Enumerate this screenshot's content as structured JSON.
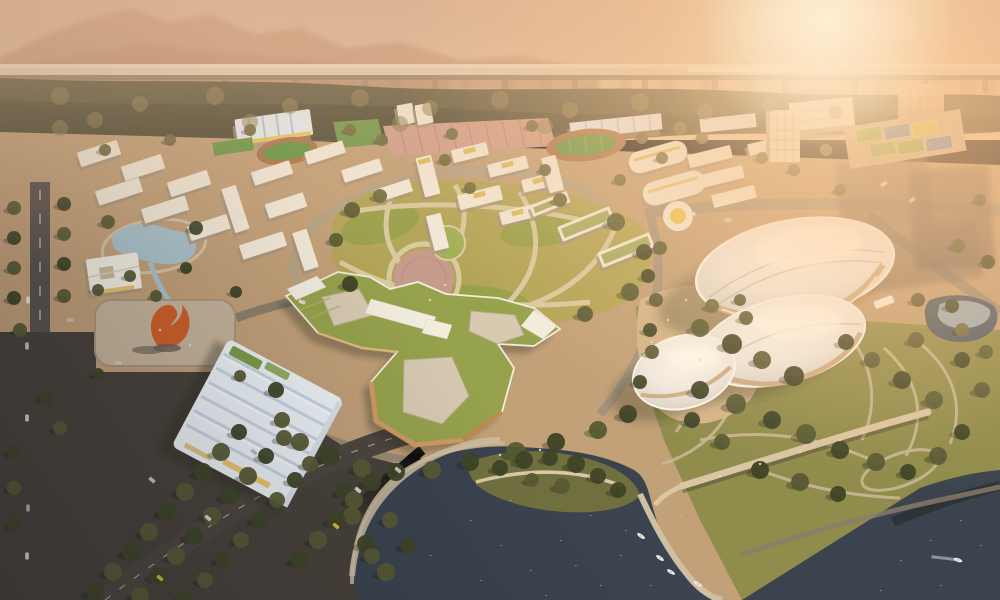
{
  "scene": {
    "title": "aerial-architectural-rendering-campus-masterplan",
    "time_of_day": "hazy-sunset",
    "elements": [
      "sky-haze",
      "mountain-ridge",
      "distant-city-skyline",
      "elevated-rail-viaduct",
      "train",
      "forest-belt",
      "sports-fields",
      "running-track",
      "parking-rows",
      "dormitory-blocks",
      "central-park-lawn",
      "star-shaped-green-roof-building",
      "pebble-shell-halls",
      "ridged-roof-gymnasium",
      "plaza-with-orange-sculpture",
      "kidney-pond",
      "courtyard-pavilion",
      "dark-lake",
      "tree-island",
      "pedestrian-bridge",
      "marina-boats",
      "tree-lined-roads",
      "glass-tower",
      "sun-glow"
    ]
  },
  "palette": {
    "skyTop": "#c9a58d",
    "skyMid": "#ddbb9b",
    "skyLow": "#e9cda8",
    "skyline": "#9b8168",
    "mountain": "#a87a5f",
    "viaductDeck": "#ddd0b8",
    "viaductShadow": "#8a7860",
    "ground": "#c2a078",
    "forest": "#55533a",
    "parkLawn": "#b2a557",
    "parkLawnDark": "#98a04a",
    "rightParkLawn": "#8f8c4c",
    "water": "#3a434e",
    "pond": "#a9c2cc",
    "plaza": "#c7b49a",
    "plazaPink": "#c59b8b",
    "sculpture": "#cf5f28",
    "greenRoof": "#96a24c",
    "courtyard": "#d7cab1",
    "pavementDark": "#474139",
    "roadMain": "#b3a284",
    "roadDark": "#564f48",
    "buildingWhite": "#f2ead9",
    "buildingShadow": "#a6937c",
    "gymRoof": "#edf2f6",
    "gymRidge": "#c6d5e2",
    "trackGreen": "#5f9340",
    "trackRing": "#a9714b",
    "parkingPink": "#cf9e8d",
    "courtsDeck": "#cdb691",
    "treeDark": "#3e4426",
    "treeMid": "#575a34",
    "treeWarm": "#6d683c",
    "canopyLight": "#8a7d4e",
    "taxiYellow": "#d9b840",
    "sparkle": "#cfd8de",
    "standBlue": "#e3ecf3",
    "standRib": "#a9c6dc",
    "accentYellow": "#e8c44f",
    "facadeOrange": "#cf9a5e",
    "shellBase": "#caa87f"
  },
  "viaduct": {
    "piers": [
      15,
      85,
      155,
      225,
      295,
      365,
      435,
      505,
      575,
      645,
      715,
      785,
      855,
      925,
      985
    ],
    "train": {
      "x": 688,
      "w": 148
    }
  },
  "skyline": [
    [
      5,
      14,
      18
    ],
    [
      30,
      10,
      26
    ],
    [
      55,
      16,
      14
    ],
    [
      90,
      12,
      30
    ],
    [
      120,
      18,
      16
    ],
    [
      150,
      10,
      24
    ],
    [
      185,
      14,
      20
    ],
    [
      230,
      12,
      34
    ],
    [
      260,
      16,
      18
    ],
    [
      295,
      12,
      42
    ],
    [
      320,
      10,
      30
    ],
    [
      350,
      16,
      20
    ],
    [
      390,
      12,
      26
    ],
    [
      430,
      18,
      16
    ],
    [
      460,
      10,
      36
    ],
    [
      500,
      14,
      22
    ],
    [
      540,
      12,
      28
    ],
    [
      580,
      16,
      18
    ],
    [
      620,
      10,
      32
    ],
    [
      660,
      14,
      24
    ],
    [
      700,
      12,
      30
    ],
    [
      740,
      16,
      40
    ],
    [
      780,
      12,
      50
    ],
    [
      810,
      16,
      34
    ],
    [
      845,
      10,
      44
    ],
    [
      875,
      14,
      28
    ],
    [
      930,
      12,
      38
    ],
    [
      960,
      16,
      24
    ],
    [
      985,
      10,
      30
    ]
  ],
  "buildings": [
    [
      78,
      146,
      42,
      15,
      -18,
      0
    ],
    [
      122,
      160,
      42,
      15,
      -18,
      0
    ],
    [
      168,
      176,
      42,
      15,
      -18,
      0
    ],
    [
      96,
      184,
      46,
      15,
      -18,
      0
    ],
    [
      142,
      202,
      46,
      15,
      -18,
      0
    ],
    [
      188,
      220,
      42,
      15,
      -18,
      0
    ],
    [
      228,
      186,
      15,
      46,
      -18,
      0
    ],
    [
      252,
      166,
      40,
      14,
      -18,
      0
    ],
    [
      266,
      198,
      40,
      15,
      -18,
      0
    ],
    [
      240,
      238,
      46,
      15,
      -18,
      0
    ],
    [
      298,
      230,
      15,
      40,
      -18,
      0
    ],
    [
      305,
      146,
      40,
      13,
      -18,
      0
    ],
    [
      342,
      164,
      40,
      13,
      -18,
      0
    ],
    [
      376,
      184,
      36,
      13,
      -18,
      0
    ],
    [
      420,
      156,
      16,
      40,
      -14,
      2
    ],
    [
      452,
      146,
      36,
      13,
      -14,
      2
    ],
    [
      488,
      160,
      40,
      13,
      -14,
      2
    ],
    [
      522,
      176,
      34,
      13,
      -14,
      2
    ],
    [
      458,
      190,
      44,
      15,
      -14,
      2
    ],
    [
      430,
      214,
      15,
      36,
      -14,
      0
    ],
    [
      545,
      156,
      15,
      36,
      -14,
      0
    ],
    [
      500,
      208,
      36,
      13,
      -14,
      2
    ],
    [
      558,
      216,
      56,
      16,
      -22,
      1
    ],
    [
      598,
      242,
      56,
      16,
      -22,
      1
    ],
    [
      530,
      198,
      40,
      12,
      -22,
      1
    ],
    [
      688,
      150,
      44,
      13,
      -14,
      0
    ],
    [
      700,
      170,
      44,
      13,
      -14,
      0
    ],
    [
      712,
      190,
      44,
      13,
      -14,
      0
    ],
    [
      748,
      140,
      36,
      12,
      -14,
      0
    ],
    [
      398,
      104,
      16,
      20,
      -10,
      0
    ],
    [
      416,
      104,
      16,
      20,
      -10,
      0
    ]
  ],
  "courts": [
    [
      856,
      128,
      26,
      13,
      "#7fae4f"
    ],
    [
      884,
      125,
      26,
      13,
      "#5f87b5"
    ],
    [
      912,
      122,
      26,
      13,
      "#d9c353"
    ],
    [
      870,
      143,
      26,
      13,
      "#8fae5f"
    ],
    [
      898,
      140,
      26,
      13,
      "#7fae4f"
    ],
    [
      926,
      137,
      26,
      13,
      "#5f87b5"
    ]
  ],
  "trees": [
    [
      60,
      96,
      9,
      3
    ],
    [
      140,
      104,
      8,
      3
    ],
    [
      215,
      96,
      9,
      3
    ],
    [
      290,
      106,
      8,
      3
    ],
    [
      360,
      98,
      9,
      3
    ],
    [
      430,
      108,
      8,
      3
    ],
    [
      500,
      100,
      9,
      3
    ],
    [
      570,
      110,
      8,
      3
    ],
    [
      640,
      102,
      9,
      3
    ],
    [
      705,
      112,
      8,
      3
    ],
    [
      770,
      104,
      8,
      3
    ],
    [
      835,
      112,
      7,
      3
    ],
    [
      95,
      120,
      8,
      3
    ],
    [
      250,
      122,
      8,
      3
    ],
    [
      400,
      124,
      8,
      3
    ],
    [
      545,
      126,
      8,
      3
    ],
    [
      680,
      128,
      7,
      3
    ],
    [
      60,
      128,
      8,
      3
    ],
    [
      352,
      210,
      8,
      1
    ],
    [
      616,
      222,
      9,
      1
    ],
    [
      644,
      252,
      8,
      0
    ],
    [
      630,
      292,
      9,
      1
    ],
    [
      585,
      314,
      8,
      1
    ],
    [
      350,
      284,
      8,
      0
    ],
    [
      336,
      240,
      7,
      1
    ],
    [
      380,
      196,
      7,
      2
    ],
    [
      560,
      200,
      7,
      2
    ],
    [
      470,
      188,
      6,
      2
    ],
    [
      300,
      442,
      9,
      1
    ],
    [
      330,
      456,
      10,
      0
    ],
    [
      362,
      468,
      9,
      1
    ],
    [
      396,
      472,
      9,
      0
    ],
    [
      432,
      470,
      9,
      1
    ],
    [
      470,
      462,
      9,
      0
    ],
    [
      516,
      452,
      10,
      1
    ],
    [
      556,
      442,
      9,
      0
    ],
    [
      598,
      430,
      9,
      1
    ],
    [
      628,
      414,
      9,
      0
    ],
    [
      282,
      420,
      8,
      1
    ],
    [
      276,
      390,
      8,
      0
    ],
    [
      500,
      468,
      8,
      0
    ],
    [
      524,
      460,
      9,
      0
    ],
    [
      550,
      458,
      8,
      0
    ],
    [
      576,
      464,
      9,
      0
    ],
    [
      598,
      476,
      8,
      0
    ],
    [
      618,
      490,
      8,
      0
    ],
    [
      562,
      486,
      8,
      1
    ],
    [
      532,
      480,
      7,
      1
    ],
    [
      352,
      516,
      9,
      1
    ],
    [
      366,
      544,
      9,
      0
    ],
    [
      386,
      572,
      9,
      1
    ],
    [
      344,
      492,
      8,
      0
    ],
    [
      700,
      328,
      9,
      1
    ],
    [
      732,
      344,
      10,
      0
    ],
    [
      762,
      360,
      9,
      1
    ],
    [
      794,
      376,
      10,
      0
    ],
    [
      700,
      390,
      9,
      0
    ],
    [
      736,
      404,
      10,
      1
    ],
    [
      772,
      420,
      9,
      0
    ],
    [
      806,
      434,
      10,
      1
    ],
    [
      840,
      450,
      9,
      0
    ],
    [
      876,
      462,
      9,
      1
    ],
    [
      908,
      472,
      8,
      0
    ],
    [
      938,
      456,
      9,
      1
    ],
    [
      962,
      432,
      8,
      0
    ],
    [
      934,
      400,
      9,
      1
    ],
    [
      902,
      380,
      9,
      0
    ],
    [
      872,
      360,
      8,
      1
    ],
    [
      846,
      342,
      8,
      0
    ],
    [
      916,
      340,
      8,
      1
    ],
    [
      962,
      360,
      8,
      0
    ],
    [
      982,
      390,
      8,
      1
    ],
    [
      760,
      470,
      9,
      0
    ],
    [
      800,
      482,
      9,
      1
    ],
    [
      838,
      494,
      8,
      0
    ],
    [
      722,
      442,
      8,
      1
    ],
    [
      692,
      420,
      8,
      0
    ],
    [
      962,
      330,
      7,
      2
    ],
    [
      986,
      352,
      7,
      1
    ],
    [
      712,
      306,
      7,
      2
    ],
    [
      746,
      318,
      7,
      1
    ],
    [
      656,
      300,
      7,
      1
    ],
    [
      650,
      330,
      7,
      0
    ],
    [
      95,
      592,
      9,
      0
    ],
    [
      113,
      572,
      9,
      1
    ],
    [
      131,
      552,
      9,
      0
    ],
    [
      149,
      532,
      9,
      1
    ],
    [
      167,
      512,
      9,
      0
    ],
    [
      185,
      492,
      9,
      1
    ],
    [
      203,
      472,
      9,
      0
    ],
    [
      221,
      452,
      9,
      1
    ],
    [
      239,
      432,
      8,
      0
    ],
    [
      140,
      596,
      9,
      1
    ],
    [
      158,
      576,
      9,
      0
    ],
    [
      176,
      556,
      9,
      1
    ],
    [
      194,
      536,
      9,
      0
    ],
    [
      212,
      516,
      9,
      1
    ],
    [
      230,
      496,
      9,
      0
    ],
    [
      248,
      476,
      9,
      1
    ],
    [
      266,
      456,
      8,
      0
    ],
    [
      284,
      438,
      8,
      1
    ],
    [
      185,
      598,
      8,
      0
    ],
    [
      205,
      580,
      8,
      1
    ],
    [
      223,
      560,
      8,
      0
    ],
    [
      241,
      540,
      8,
      1
    ],
    [
      259,
      520,
      8,
      0
    ],
    [
      277,
      500,
      8,
      1
    ],
    [
      295,
      480,
      8,
      0
    ],
    [
      310,
      464,
      8,
      1
    ],
    [
      300,
      560,
      9,
      0
    ],
    [
      318,
      540,
      9,
      1
    ],
    [
      336,
      520,
      9,
      0
    ],
    [
      354,
      500,
      9,
      1
    ],
    [
      372,
      482,
      9,
      0
    ],
    [
      390,
      520,
      8,
      1
    ],
    [
      408,
      546,
      8,
      0
    ],
    [
      372,
      556,
      8,
      1
    ],
    [
      14,
      208,
      7,
      1
    ],
    [
      14,
      238,
      7,
      0
    ],
    [
      14,
      268,
      7,
      1
    ],
    [
      14,
      298,
      7,
      0
    ],
    [
      64,
      204,
      7,
      0
    ],
    [
      64,
      234,
      7,
      1
    ],
    [
      64,
      264,
      7,
      0
    ],
    [
      64,
      296,
      7,
      1
    ],
    [
      20,
      330,
      7,
      1
    ],
    [
      14,
      452,
      7,
      0
    ],
    [
      14,
      488,
      7,
      1
    ],
    [
      14,
      524,
      7,
      0
    ],
    [
      60,
      428,
      7,
      1
    ],
    [
      46,
      398,
      7,
      0
    ],
    [
      108,
      222,
      7,
      1
    ],
    [
      196,
      228,
      7,
      0
    ],
    [
      130,
      276,
      6,
      1
    ],
    [
      186,
      268,
      6,
      0
    ],
    [
      156,
      296,
      6,
      1
    ],
    [
      98,
      290,
      6,
      1
    ],
    [
      236,
      292,
      6,
      0
    ],
    [
      98,
      374,
      6,
      0
    ],
    [
      240,
      376,
      6,
      1
    ],
    [
      350,
      130,
      6,
      2
    ],
    [
      382,
      140,
      6,
      2
    ],
    [
      452,
      134,
      6,
      2
    ],
    [
      532,
      126,
      6,
      2
    ],
    [
      642,
      138,
      6,
      2
    ],
    [
      662,
      158,
      6,
      2
    ],
    [
      702,
      138,
      6,
      2
    ],
    [
      762,
      158,
      6,
      2
    ],
    [
      794,
      170,
      6,
      2
    ],
    [
      826,
      150,
      6,
      2
    ],
    [
      250,
      130,
      6,
      2
    ],
    [
      170,
      140,
      6,
      2
    ],
    [
      105,
      150,
      6,
      2
    ],
    [
      445,
      160,
      6,
      2
    ],
    [
      545,
      170,
      6,
      2
    ],
    [
      620,
      180,
      6,
      2
    ],
    [
      660,
      248,
      7,
      1
    ],
    [
      648,
      276,
      7,
      0
    ],
    [
      652,
      352,
      7,
      1
    ],
    [
      640,
      382,
      7,
      0
    ],
    [
      740,
      300,
      6,
      1
    ],
    [
      840,
      190,
      6,
      2
    ],
    [
      980,
      200,
      6,
      1
    ],
    [
      958,
      246,
      7,
      1
    ],
    [
      988,
      262,
      7,
      0
    ],
    [
      918,
      300,
      7,
      1
    ],
    [
      952,
      306,
      7,
      0
    ]
  ],
  "cars": [
    [
      28,
      300,
      90,
      "#e9e5db"
    ],
    [
      27,
      346,
      90,
      "#cac5bb"
    ],
    [
      27,
      418,
      90,
      "#d9d5cb"
    ],
    [
      28,
      508,
      90,
      "#b9b5ab"
    ],
    [
      27,
      556,
      90,
      "#e1ddd3"
    ],
    [
      118,
      363,
      0,
      "#d1cdc3"
    ],
    [
      152,
      480,
      40,
      "#c9c5bb"
    ],
    [
      208,
      518,
      40,
      "#d9d5cb"
    ],
    [
      254,
      452,
      40,
      "#c1bdb3"
    ],
    [
      336,
      526,
      40,
      "#d9b840"
    ],
    [
      160,
      578,
      40,
      "#d9b840"
    ],
    [
      358,
      490,
      40,
      "#d8d4ca"
    ],
    [
      398,
      470,
      40,
      "#c9c5bb"
    ],
    [
      692,
      214,
      0,
      "#e9e5db"
    ],
    [
      728,
      220,
      0,
      "#d1cdc3"
    ],
    [
      884,
      184,
      -35,
      "#d9d5cb"
    ],
    [
      912,
      200,
      -40,
      "#c9c5bb"
    ],
    [
      302,
      302,
      20,
      "#dcd8ce"
    ],
    [
      70,
      320,
      0,
      "#c9c5bb"
    ]
  ],
  "boats": [
    [
      641,
      536,
      35,
      0
    ],
    [
      660,
      558,
      35,
      0
    ],
    [
      671,
      572,
      30,
      0
    ],
    [
      698,
      584,
      30,
      0
    ],
    [
      958,
      560,
      20,
      1
    ]
  ],
  "figures": [
    [
      720,
      476
    ],
    [
      760,
      464
    ],
    [
      800,
      452
    ],
    [
      840,
      440
    ],
    [
      686,
      300
    ],
    [
      668,
      320
    ],
    [
      652,
      342
    ],
    [
      700,
      360
    ],
    [
      430,
      300
    ],
    [
      445,
      285
    ],
    [
      500,
      455
    ],
    [
      540,
      450
    ],
    [
      160,
      330
    ],
    [
      190,
      345
    ]
  ],
  "sparkles": [
    [
      470,
      520
    ],
    [
      500,
      545
    ],
    [
      530,
      570
    ],
    [
      560,
      540
    ],
    [
      590,
      515
    ],
    [
      620,
      555
    ],
    [
      650,
      585
    ],
    [
      480,
      580
    ],
    [
      430,
      555
    ],
    [
      545,
      595
    ],
    [
      600,
      585
    ],
    [
      900,
      560
    ],
    [
      930,
      540
    ],
    [
      960,
      520
    ],
    [
      980,
      545
    ],
    [
      940,
      585
    ],
    [
      880,
      590
    ],
    [
      700,
      540
    ],
    [
      680,
      515
    ],
    [
      510,
      500
    ],
    [
      575,
      565
    ],
    [
      625,
      530
    ]
  ]
}
